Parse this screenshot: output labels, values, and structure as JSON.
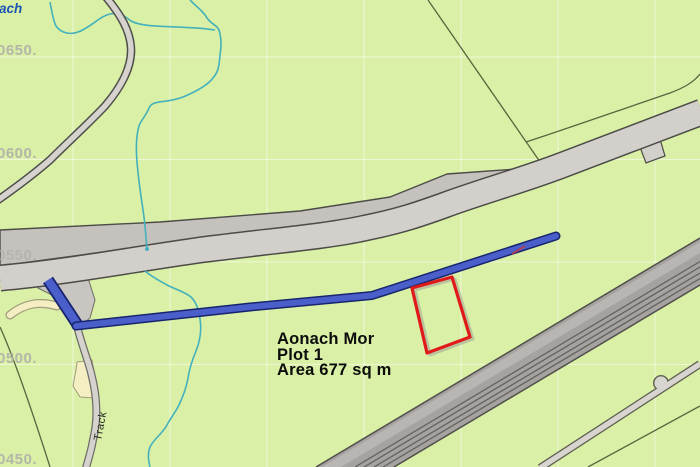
{
  "map": {
    "plot_annotation": {
      "line1": "Aonach Mor",
      "line2": "Plot 1",
      "line3": "Area 677 sq m"
    },
    "grid_labels": [
      {
        "text": "0650."
      },
      {
        "text": "0600."
      },
      {
        "text": "0550."
      },
      {
        "text": "0500."
      },
      {
        "text": "0450."
      }
    ],
    "track_label": "Track",
    "stream_label_fragment": "ach"
  },
  "colors": {
    "background": "#d9f0a6",
    "road_fill": "#d3cfca",
    "road_wide_fill": "#c5c1bc",
    "road_casing": "#4b4b47",
    "dual_carriageway_fill": "#a5a29f",
    "minor_road_fill": "#d8d5d1",
    "track_fill": "#d6d3cf",
    "path_cream": "#f4eec2",
    "stream_teal": "#44b1bc",
    "way_blue": "#4a5fc9",
    "way_blue_casing": "#17246f",
    "plot_red": "#e01a1a",
    "grid_label_gray": "#b1b0ab",
    "stream_label_blue": "#1c53b4"
  }
}
